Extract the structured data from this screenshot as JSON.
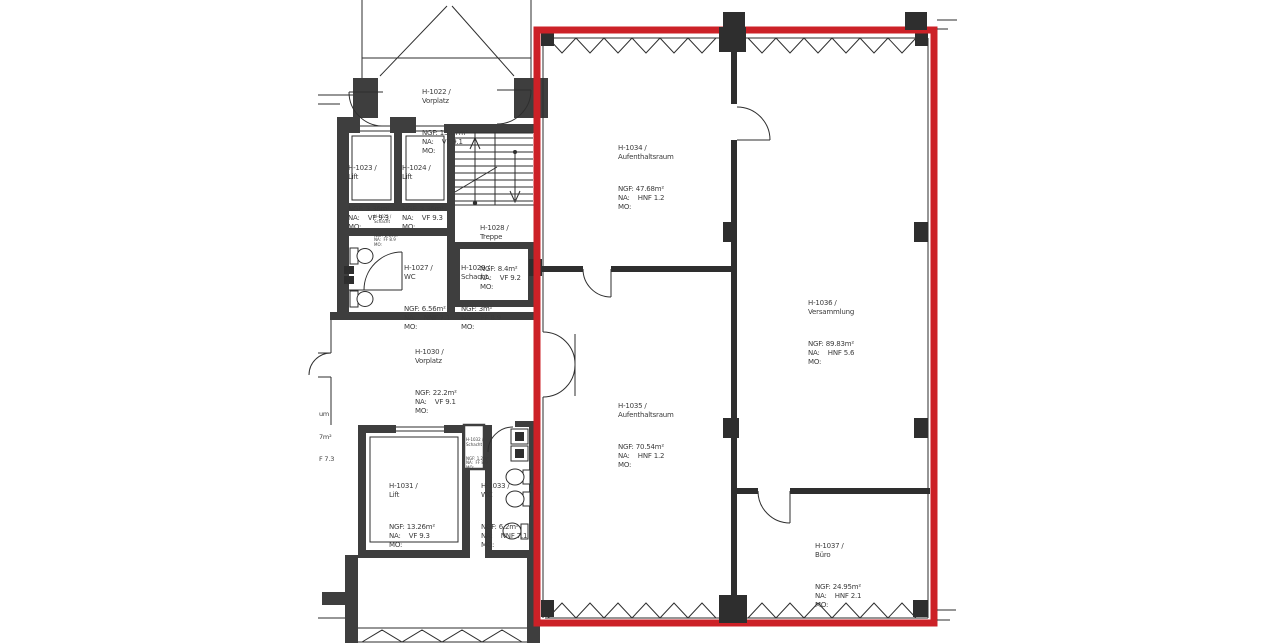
{
  "plan": {
    "type": "architectural-floor-plan",
    "highlight_color": "#cc2127",
    "wall_color": "#3e3e3e",
    "line_color": "#2e2e2e"
  },
  "rooms": [
    {
      "code": "H-1022 /",
      "name": "Vorplatz",
      "ngf": "NGF: 13.07m²",
      "na": "NA:    VF 9.1",
      "mo": "MO:"
    },
    {
      "code": "H-1023 /",
      "name": "Lift",
      "ngf": "NGF: 3.36m²",
      "na": "NA:    VF 9.3",
      "mo": "MO:"
    },
    {
      "code": "H-1024 /",
      "name": "Lift",
      "ngf": "NGF: 3.36m²",
      "na": "NA:    VF 9.3",
      "mo": "MO:"
    },
    {
      "code": "H-1025 /",
      "name": "Schacht",
      "ngf": "NGF: 2.09m²",
      "na": "NA:  FF 8.9",
      "mo": "MO:"
    },
    {
      "code": "H-1028 /",
      "name": "Treppe",
      "ngf": "NGF: 8.4m²",
      "na": "NA:    VF 9.2",
      "mo": "MO:"
    },
    {
      "code": "H-1027 /",
      "name": "WC",
      "ngf": "NGF: 6.56m²",
      "na": "NA:    NNF 7.1",
      "mo": "MO:"
    },
    {
      "code": "H-1029 /",
      "name": "Schacht",
      "ngf": "NGF: 3m²",
      "na": "NA:    FF 8.9",
      "mo": "MO:"
    },
    {
      "code": "H-1030 /",
      "name": "Vorplatz",
      "ngf": "NGF: 22.2m²",
      "na": "NA:    VF 9.1",
      "mo": "MO:"
    },
    {
      "code": "H-1031 /",
      "name": "Lift",
      "ngf": "NGF: 13.26m²",
      "na": "NA:    VF 9.3",
      "mo": "MO:"
    },
    {
      "code": "H-1032 /",
      "name": "Schacht",
      "ngf": "NGF: 1.2m²",
      "na": "NA:  FF 8.9",
      "mo": "MO:"
    },
    {
      "code": "H-1033 /",
      "name": "WC",
      "ngf": "NGF: 6.2m²",
      "na": "NA:    NNF 7.1",
      "mo": "MO:"
    },
    {
      "code": "H-1034 /",
      "name": "Aufenthaltsraum",
      "ngf": "NGF: 47.68m²",
      "na": "NA:    HNF 1.2",
      "mo": "MO:"
    },
    {
      "code": "H-1035 /",
      "name": "Aufenthaltsraum",
      "ngf": "NGF: 70.54m²",
      "na": "NA:    HNF 1.2",
      "mo": "MO:"
    },
    {
      "code": "H-1036 /",
      "name": "Versammlung",
      "ngf": "NGF: 89.83m²",
      "na": "NA:    HNF 5.6",
      "mo": "MO:"
    },
    {
      "code": "H-1037 /",
      "name": "Büro",
      "ngf": "NGF: 24.95m²",
      "na": "NA:    HNF 2.1",
      "mo": "MO:"
    }
  ],
  "partial_label": {
    "line1": "um",
    "line2": "7m²",
    "line3": "F 7.3"
  }
}
